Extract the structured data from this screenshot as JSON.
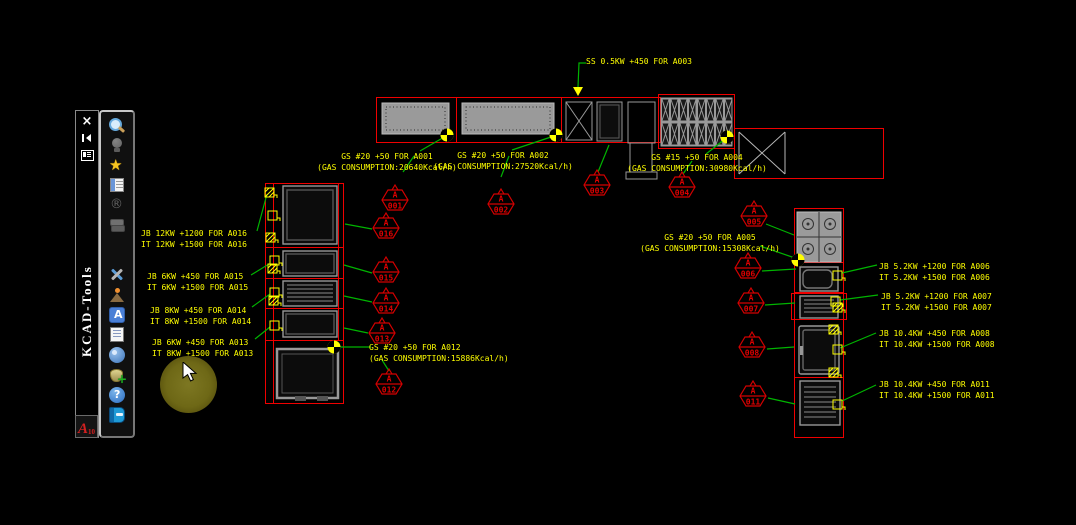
{
  "toolbar": {
    "title": "KCAD-Tools",
    "close_glyph": "×",
    "logo_a": "A",
    "logo_sub": "10",
    "icons": [
      {
        "name": "search",
        "enabled": true
      },
      {
        "name": "idea-bulb",
        "enabled": false
      },
      {
        "name": "favorites-star",
        "enabled": true
      },
      {
        "name": "task-list",
        "enabled": true
      },
      {
        "name": "registered-mark",
        "enabled": false
      },
      {
        "name": "layer-stack",
        "enabled": false
      },
      {
        "name": "tools",
        "enabled": true,
        "gap_before": true
      },
      {
        "name": "terrain",
        "enabled": true
      },
      {
        "name": "text-style",
        "enabled": true
      },
      {
        "name": "report",
        "enabled": true
      },
      {
        "name": "user-profile",
        "enabled": true
      },
      {
        "name": "database-add",
        "enabled": true
      },
      {
        "name": "help",
        "enabled": true
      },
      {
        "name": "manual-book",
        "enabled": true
      }
    ]
  },
  "colors": {
    "cad_red": "#ef0000",
    "tag_red": "#d40000",
    "annotation_yellow": "#ffff00",
    "leader_green": "#00b400",
    "equipment_gray": "#989898",
    "cursor_glow_olive": "#6e6816"
  },
  "drawing": {
    "labels": [
      {
        "id": "a001",
        "x": 387,
        "y": 151,
        "center": true,
        "lines": [
          "GS #20 +50 FOR A001",
          "(GAS CONSUMPTION:20640Kcal/h)"
        ]
      },
      {
        "id": "a002",
        "x": 503,
        "y": 150,
        "center": true,
        "lines": [
          "GS #20 +50 FOR A002",
          "(GAS CONSUMPTION:27520Kcal/h)"
        ]
      },
      {
        "id": "a003",
        "x": 586,
        "y": 56,
        "center": false,
        "lines": [
          "SS 0.5KW +450 FOR A003"
        ]
      },
      {
        "id": "a004",
        "x": 697,
        "y": 152,
        "center": true,
        "lines": [
          "GS #15 +50 FOR A004",
          "(GAS CONSUMPTION:30980Kcal/h)"
        ]
      },
      {
        "id": "a005",
        "x": 710,
        "y": 232,
        "center": true,
        "lines": [
          "GS #20 +50 FOR A005",
          "(GAS CONSUMPTION:15308Kcal/h)"
        ]
      },
      {
        "id": "a012",
        "x": 369,
        "y": 342,
        "center": false,
        "lines": [
          "GS #20 +50 FOR A012",
          "(GAS CONSUMPTION:15886Kcal/h)"
        ]
      },
      {
        "id": "a016",
        "x": 141,
        "y": 228,
        "center": false,
        "lines": [
          "JB 12KW +1200 FOR A016",
          "IT 12KW +1500 FOR A016"
        ]
      },
      {
        "id": "a015",
        "x": 147,
        "y": 271,
        "center": false,
        "lines": [
          "JB 6KW +450 FOR A015",
          "IT 6KW +1500 FOR A015"
        ]
      },
      {
        "id": "a014",
        "x": 150,
        "y": 305,
        "center": false,
        "lines": [
          "JB 8KW +450 FOR A014",
          "IT 8KW +1500 FOR A014"
        ]
      },
      {
        "id": "a013",
        "x": 152,
        "y": 337,
        "center": false,
        "lines": [
          "JB 6KW +450 FOR A013",
          "IT 8KW +1500 FOR A013"
        ]
      },
      {
        "id": "a006",
        "x": 879,
        "y": 261,
        "center": false,
        "lines": [
          "JB 5.2KW +1200 FOR A006",
          "IT 5.2KW +1500 FOR A006"
        ]
      },
      {
        "id": "a007",
        "x": 881,
        "y": 291,
        "center": false,
        "lines": [
          "JB 5.2KW +1200 FOR A007",
          "IT 5.2KW +1500 FOR A007"
        ]
      },
      {
        "id": "a008",
        "x": 879,
        "y": 328,
        "center": false,
        "lines": [
          "JB 10.4KW +450 FOR A008",
          "IT 10.4KW +1500 FOR A008"
        ]
      },
      {
        "id": "a011",
        "x": 879,
        "y": 379,
        "center": false,
        "lines": [
          "JB 10.4KW +450 FOR A011",
          "IT 10.4KW +1500 FOR A011"
        ]
      }
    ],
    "tags": [
      {
        "top": "A",
        "num": "001",
        "cx": 395,
        "cy": 200
      },
      {
        "top": "A",
        "num": "002",
        "cx": 501,
        "cy": 204
      },
      {
        "top": "A",
        "num": "003",
        "cx": 597,
        "cy": 185
      },
      {
        "top": "A",
        "num": "004",
        "cx": 682,
        "cy": 187
      },
      {
        "top": "A",
        "num": "005",
        "cx": 754,
        "cy": 216
      },
      {
        "top": "A",
        "num": "006",
        "cx": 748,
        "cy": 268
      },
      {
        "top": "A",
        "num": "007",
        "cx": 751,
        "cy": 303
      },
      {
        "top": "A",
        "num": "008",
        "cx": 752,
        "cy": 347
      },
      {
        "top": "A",
        "num": "011",
        "cx": 753,
        "cy": 396
      },
      {
        "top": "A",
        "num": "012",
        "cx": 389,
        "cy": 384
      },
      {
        "top": "A",
        "num": "013",
        "cx": 382,
        "cy": 333
      },
      {
        "top": "A",
        "num": "014",
        "cx": 386,
        "cy": 303
      },
      {
        "top": "A",
        "num": "015",
        "cx": 386,
        "cy": 272
      },
      {
        "top": "A",
        "num": "016",
        "cx": 386,
        "cy": 228
      }
    ]
  }
}
